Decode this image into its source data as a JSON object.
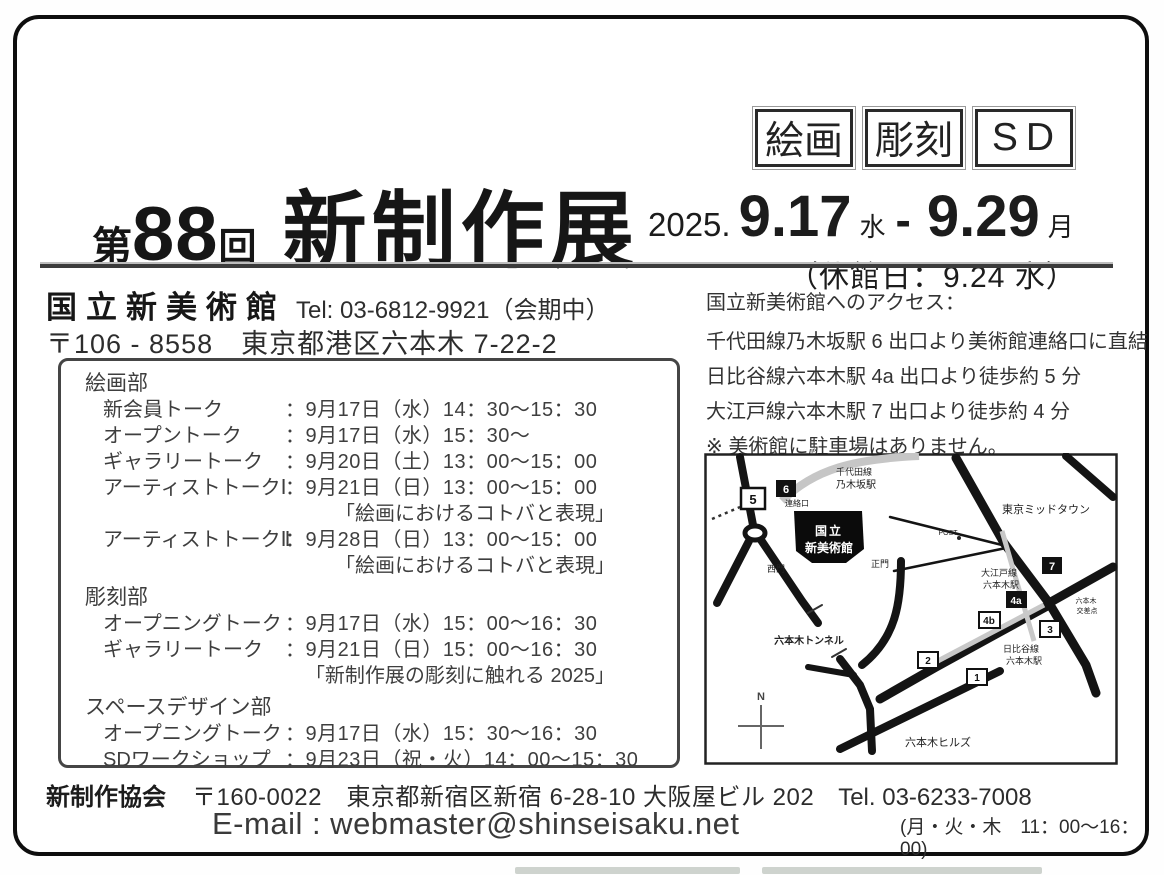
{
  "badges": {
    "b1": "絵画",
    "b2": "彫刻",
    "b3": "SD"
  },
  "title": {
    "dai": "第",
    "number": "88",
    "kai": "回",
    "name": "新制作展"
  },
  "dates": {
    "year": "2025.",
    "start": "9.17",
    "start_day": "水",
    "dash": "-",
    "end": "9.29",
    "end_day": "月",
    "closed": "（休館日：9.24 水）"
  },
  "venue": {
    "name": "国立新美術館",
    "tel": "Tel: 03-6812-9921（会期中）",
    "address": "〒106 - 8558　東京都港区六本木 7-22-2"
  },
  "schedule": {
    "sections": [
      {
        "heading": "絵画部",
        "rows": [
          {
            "label": "新会員トーク",
            "time": "：9月17日（水）14：30～15：30"
          },
          {
            "label": "オープントーク",
            "time": "：9月17日（水）15：30～"
          },
          {
            "label": "ギャラリートーク",
            "time": "：9月20日（土）13：00～15：00"
          },
          {
            "label": "アーティストトークⅠ",
            "time": "：9月21日（日）13：00～15：00",
            "note": "「絵画におけるコトバと表現」"
          },
          {
            "label": "アーティストトークⅡ",
            "time": "：9月28日（日）13：00～15：00",
            "note": "「絵画におけるコトバと表現」"
          }
        ]
      },
      {
        "heading": "彫刻部",
        "rows": [
          {
            "label": "オープニングトーク",
            "time": "：9月17日（水）15：00～16：30"
          },
          {
            "label": "ギャラリートーク",
            "time": "：9月21日（日）15：00～16：30",
            "note": "「新制作展の彫刻に触れる 2025」"
          }
        ]
      },
      {
        "heading": "スペースデザイン部",
        "rows": [
          {
            "label": "オープニングトーク",
            "time": "：9月17日（水）15：30～16：30"
          },
          {
            "label": "SDワークショップ",
            "time": "：9月23日（祝・火）14：00～15：30"
          }
        ]
      }
    ]
  },
  "access": {
    "heading": "国立新美術館へのアクセス：",
    "lines": [
      "千代田線乃木坂駅 6 出口より美術館連絡口に直結",
      "日比谷線六本木駅 4a 出口より徒歩約 5 分",
      "大江戸線六本木駅 7 出口より徒歩約 4 分",
      "※ 美術館に駐車場はありません。"
    ]
  },
  "map": {
    "north": "N",
    "labels": {
      "chiyoda_line": "千代田線",
      "nogizaka_station": "乃木坂駅",
      "renrakuguchi": "連絡口",
      "museum_line1": "国立",
      "museum_line2": "新美術館",
      "west_gate": "西門",
      "main_gate": "正門",
      "midtown": "東京ミッドタウン",
      "post": "POST",
      "oedo_line": "大江戸線",
      "roppongi_station_oedo": "六本木駅",
      "crossing_line1": "六本木",
      "crossing_line2": "交差点",
      "hibiya_line": "日比谷線",
      "roppongi_station_hibiya": "六本木駅",
      "tunnel": "六本木トンネル",
      "hills": "六本木ヒルズ"
    },
    "exits": {
      "e5": "5",
      "e6": "6",
      "e7": "7",
      "e4a": "4a",
      "e4b": "4b",
      "e3": "3",
      "e2": "2",
      "e1": "1"
    }
  },
  "footer": {
    "org": "新制作協会",
    "address": "〒160-0022　東京都新宿区新宿 6-28-10 大阪屋ビル 202",
    "tel": "Tel. 03-6233-7008",
    "email": "E-mail : webmaster@shinseisaku.net",
    "hours": "(月・火・木　11：00～16：00)"
  },
  "colors": {
    "ink": "#1a1a1a",
    "scan_gray": "#3e3e3e"
  }
}
